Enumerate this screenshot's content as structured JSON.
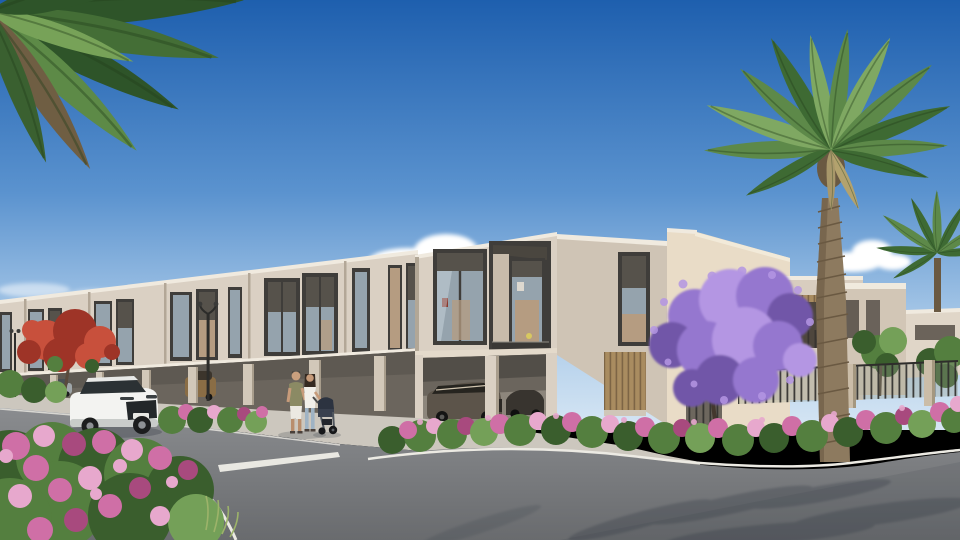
{
  "meta": {
    "title": "Residential community exterior rendering",
    "description": "Sunny daytime architectural rendering of a row of modern beige two-storey townhouses with carports, palm trees, a purple jacaranda, pink bougainvillea hedges, a curving asphalt road with white lane markings, a white SUV, parked cars, and a couple walking with a stroller."
  },
  "labels": {
    "sky": "blue sky",
    "clouds": "white clouds",
    "townhouse_row": "receding row of modern townhouses",
    "near_townhouse": "corner townhouse block with double-height glazing",
    "right_houses": "villas behind boundary fence",
    "fence": "dark metal boundary fence with stone pillars",
    "palm_left": "overhanging palm fronds (top left)",
    "palm_right": "tall date palm",
    "palm_far_right": "second palm tree",
    "jacaranda": "purple flowering jacaranda tree",
    "flame_tree": "red flowering flame tree",
    "bougainvillea_front": "foreground bougainvillea bush",
    "bougainvillea_corner": "corner bougainvillea hedge",
    "road": "asphalt road",
    "lane_marking": "white dashed lane marking",
    "curb_line": "white curb edge line",
    "sidewalk": "light concrete sidewalk",
    "white_suv": "white SUV driving on road",
    "silver_car": "parked silver car",
    "gold_suv": "gold SUV parked in carport",
    "carport_sedan": "bronze sedan parked under carport",
    "second_carport_car": "dark car in carport shadow",
    "family": "couple walking with baby stroller",
    "stroller": "dark baby stroller",
    "street_lamp_near": "double-arm street lamp",
    "street_lamp_far": "distant street lamp",
    "palm_shadows": "palm frond shadows on asphalt"
  },
  "palette": {
    "skyTop": "#1e5fae",
    "skyMid": "#5b93cf",
    "skyLow": "#a9c9e8",
    "skyHorizon": "#d6e6f4",
    "cloud": "#ffffff",
    "wallLit": "#dad0c3",
    "wallMid": "#cfc4b5",
    "wallShade": "#b2a796",
    "parapet": "#f0eadf",
    "frameDark": "#3f3d3a",
    "glass": "#95a3ad",
    "glassDark": "#56524b",
    "interiorWarm": "#b59c81",
    "carportShade": "#6b655d",
    "carportBack": "#8d867c",
    "roadLight": "#8a8c8f",
    "roadDark": "#696b6e",
    "sidewalk": "#ccc7be",
    "curb": "#eceae3",
    "hedgeGreen": "#547f3f",
    "hedgeGreenDark": "#3a5e2d",
    "hedgeGreenLight": "#74a058",
    "pink": "#cf6fa6",
    "pinkLight": "#e7a8cd",
    "pinkDeep": "#a84a7e",
    "palmGreen": "#5d8949",
    "palmGreenDark": "#3e6a33",
    "palmGreenLight": "#7fa862",
    "trunk": "#8d7a5f",
    "trunkDark": "#6a5942",
    "jacaranda": "#9577cf",
    "jacarandaLight": "#b496e3",
    "jacarandaDark": "#7156a8",
    "flameRed": "#c8503c",
    "flameRedDark": "#9e3427",
    "suvWhite": "#f3f3f1",
    "shadowColor": "#2f3640"
  }
}
